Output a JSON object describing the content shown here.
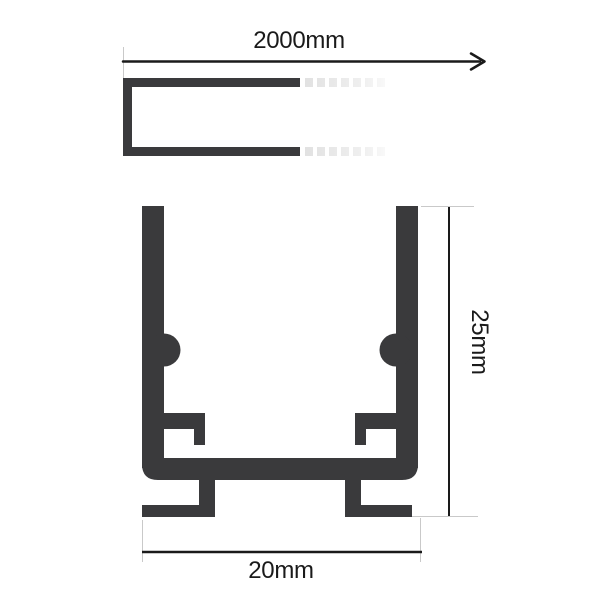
{
  "diagram": {
    "type": "technical-drawing",
    "subject": "u-channel-profile-dimensions",
    "views": {
      "length_view": {
        "description": "side view of channel with break (faded dashes) and length arrow",
        "dimension_label": "2000mm"
      },
      "cross_section_view": {
        "description": "cross section of u-channel with inner clips, pcb ledges and mounting feet",
        "height_label": "25mm",
        "width_label": "20mm"
      }
    },
    "colors": {
      "profile": "#3a3a3c",
      "dimension_line": "#1a1a1a",
      "extension_line": "#c9c9c9",
      "fade_dash": "#e2e2e2",
      "background": "#ffffff"
    }
  }
}
